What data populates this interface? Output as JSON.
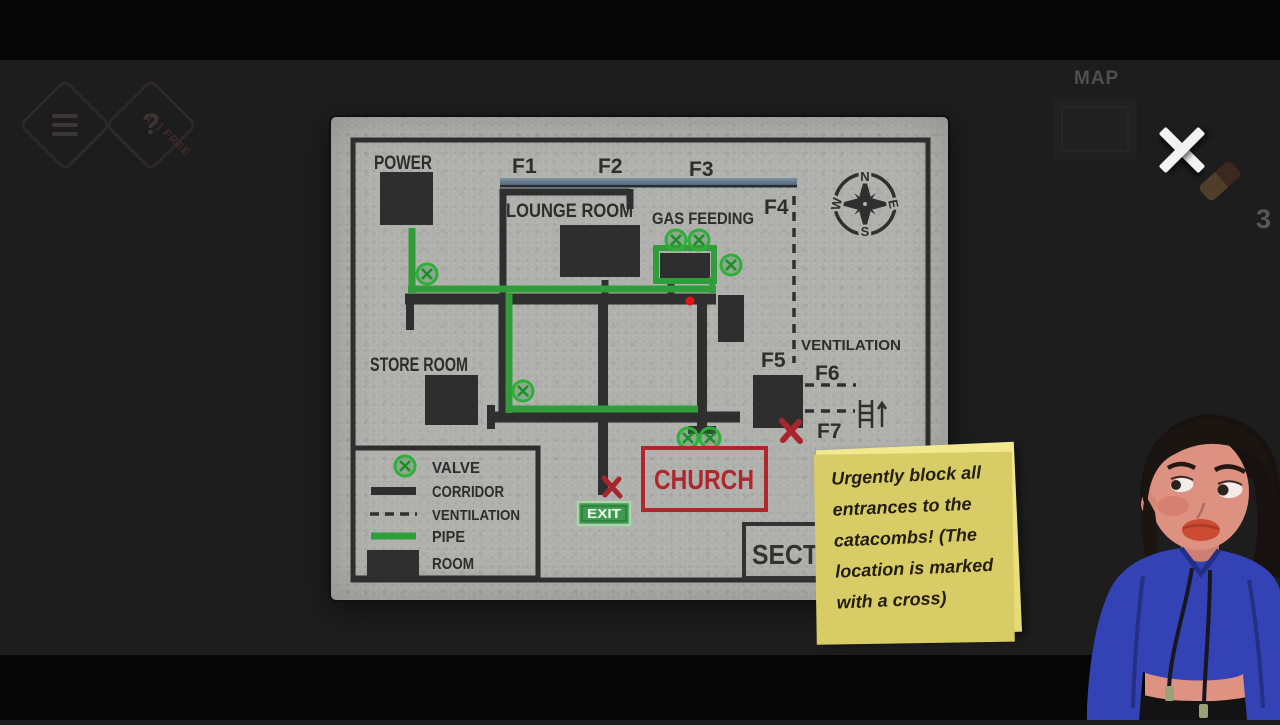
{
  "hud": {
    "map_label": "MAP",
    "inventory_count": "3",
    "free_ribbon": "(+) FREE",
    "help_glyph": "?"
  },
  "map": {
    "rooms": {
      "power": "POWER",
      "lounge": "LOUNGE ROOM",
      "gas": "GAS FEEDING",
      "store": "STORE ROOM",
      "ventilation": "VENTILATION"
    },
    "floor_marks": [
      "F1",
      "F2",
      "F3",
      "F4",
      "F5",
      "F6",
      "F7"
    ],
    "compass": {
      "north": "N",
      "east": "E",
      "south": "S",
      "west": "W"
    },
    "legend": {
      "valve": "VALVE",
      "corridor": "CORRIDOR",
      "ventilation": "VENTILATION",
      "pipe": "PIPE",
      "room": "ROOM"
    },
    "signs": {
      "church": "CHURCH",
      "exit": "EXIT",
      "sect_partial": "SECT"
    }
  },
  "note": {
    "text": "Urgently block all\nentrances to the\ncatacombs! (The\nlocation is marked\nwith a cross)"
  },
  "colors": {
    "pipe_green": "#2f9e3a",
    "valve_green": "#2fae3a",
    "alert_red": "#b0262c",
    "marker_red": "#e01616",
    "exit_green": "#3f9b4d",
    "note_yellow": "#ece27f",
    "corridor_dark": "#2f2f2f",
    "map_grey": "#b1b1ad",
    "hoodie_blue": "#3343b5"
  }
}
